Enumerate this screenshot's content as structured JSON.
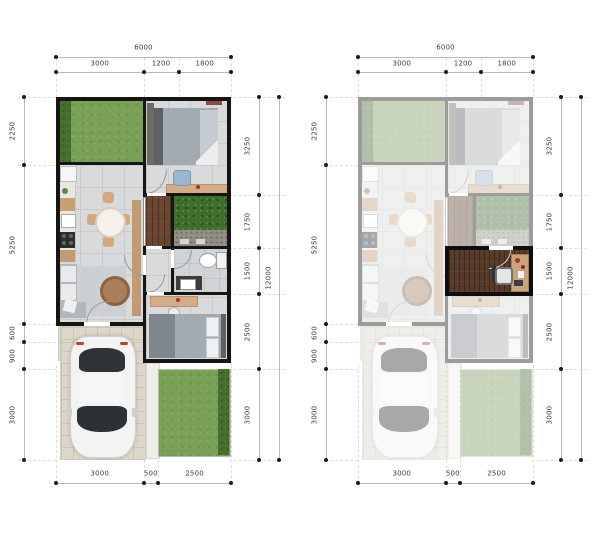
{
  "figure": {
    "type": "floor-plan-comparison",
    "plans": [
      {
        "name": "base-plan",
        "variant": "full-color"
      },
      {
        "name": "workspace-option-plan",
        "variant": "muted-with-highlighted-workspace"
      }
    ]
  },
  "dimensions": {
    "top": {
      "overall": "6000",
      "segments": [
        "3000",
        "1200",
        "1800"
      ]
    },
    "left_side": [
      "2250",
      "5250",
      "600",
      "900",
      "3000"
    ],
    "right_side": {
      "overall": "12000",
      "segments": [
        "3250",
        "1750",
        "1500",
        "2500",
        "3000"
      ]
    },
    "bottom": {
      "segments": [
        "3000",
        "500",
        "2500"
      ]
    }
  },
  "palette": {
    "wall": "#151515",
    "muted_wall": "#9b9b9b",
    "grass": "#79a055",
    "hedge": "#466f2e",
    "deck_wood": "#6a452f",
    "highlight_wood": "#573a28",
    "floor_tile": "#d9dadb",
    "paver": "#dcd7c9",
    "furniture_wood": "#d2ad87",
    "dimension_text": "#3b3b3b",
    "background": "#ffffff"
  }
}
